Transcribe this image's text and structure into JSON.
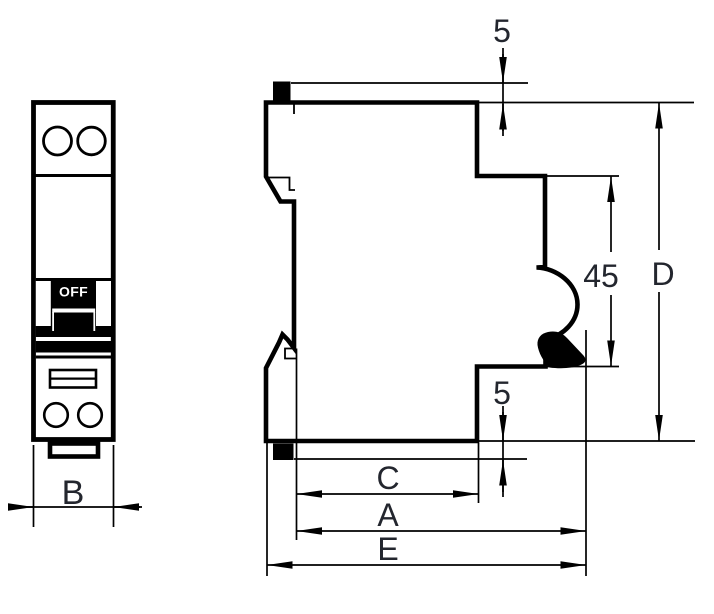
{
  "drawing": {
    "kind": "technical dimension drawing",
    "subject": "single-module DIN-rail miniature circuit breaker, front view and side view"
  },
  "labels": {
    "switch_state": "OFF",
    "dim_width_b": "B",
    "dim_top_clip_offset": "5",
    "dim_front_panel_height": "45",
    "dim_overall_height_d": "D",
    "dim_bottom_clip_offset": "5",
    "dim_depth_c": "C",
    "dim_depth_a": "A",
    "dim_depth_e": "E"
  },
  "colors": {
    "line": "#000000",
    "label_text": "#23262e",
    "switch_text": "#ffffff",
    "background": "#ffffff"
  }
}
